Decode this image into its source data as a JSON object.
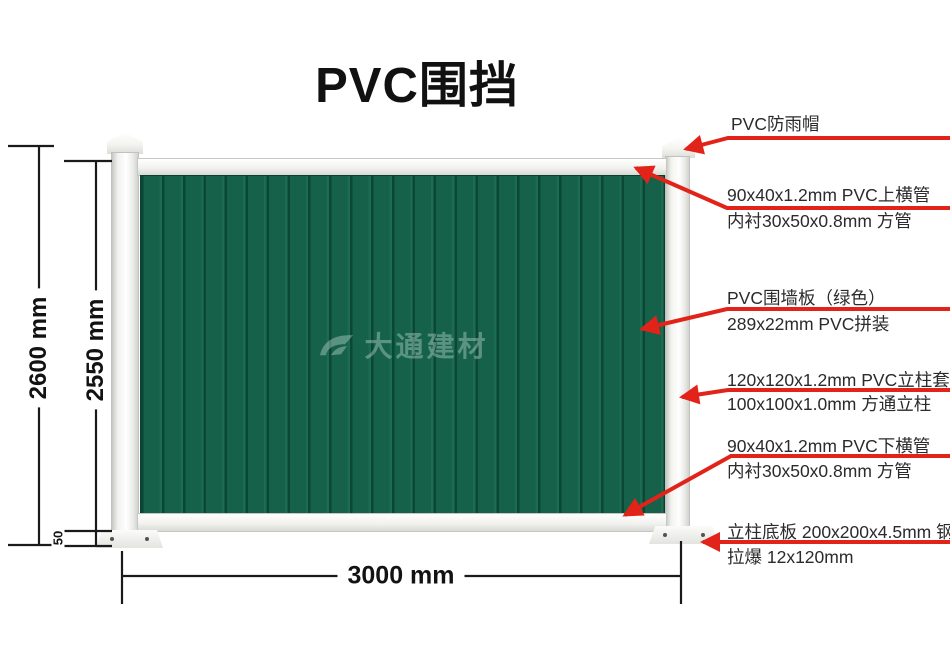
{
  "title": "PVC围挡",
  "watermark_text": "大通建材",
  "dims": {
    "total_height": "2600 mm",
    "panel_height": "2550 mm",
    "base_offset": "50",
    "width": "3000 mm"
  },
  "annotations": [
    {
      "lines": [
        "PVC防雨帽"
      ]
    },
    {
      "lines": [
        "90x40x1.2mm PVC上横管",
        "内衬30x50x0.8mm 方管"
      ]
    },
    {
      "lines": [
        "PVC围墙板（绿色）",
        "289x22mm PVC拼装"
      ]
    },
    {
      "lines": [
        "120x120x1.2mm PVC立柱套",
        "100x100x1.0mm 方通立柱"
      ]
    },
    {
      "lines": [
        "90x40x1.2mm PVC下横管",
        "内衬30x50x0.8mm 方管"
      ]
    },
    {
      "lines": [
        "立柱底板 200x200x4.5mm 钢板",
        "拉爆 12x120mm"
      ]
    }
  ],
  "colors": {
    "panel_green": "#15614a",
    "panel_groove": "#0c4736",
    "arrow_red": "#e2231a",
    "dimension_black": "#1a1a1a",
    "post_white": "#f2f2ef"
  }
}
